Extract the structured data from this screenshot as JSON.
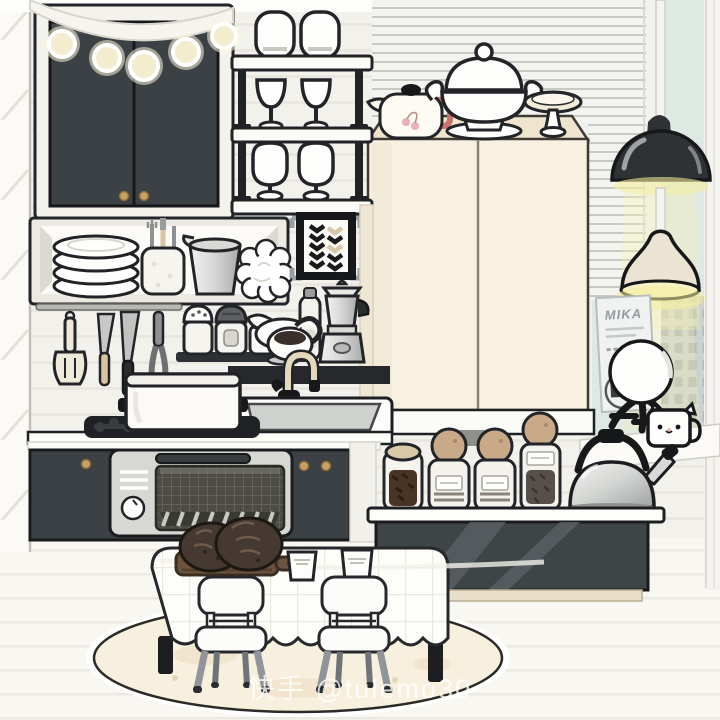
{
  "scene": {
    "name": "toca-style-kitchen-scene",
    "watermark": "快手 @tulemo30",
    "poster": {
      "title": "MIKA"
    }
  },
  "palette": {
    "cabinet_charcoal": "#3c4145",
    "outline_black": "#1c1e22",
    "fridge_cream": "#f8f1e1",
    "counter_white": "#fdfdfa",
    "knob_gold": "#c9a163",
    "lamp_glow_yellow": "#f5ef9e",
    "window_glass": "#dfe9e4",
    "bread_brown": "#463931",
    "board_brown": "#6b5340",
    "rug_cream": "#f7f0de",
    "jar_lid_tan": "#c8a988",
    "metal_silver": "#c6c8c6"
  },
  "inventory": [
    "string-lights",
    "upper-cabinet",
    "wine-glass-rack",
    "stemless-glasses",
    "wine-glasses",
    "goblets",
    "plate-stack",
    "utensil-crock",
    "metal-pitcher",
    "ruffle-decor",
    "chevron-art-frame",
    "spatula",
    "paring-knife",
    "chef-knife",
    "carving-fork",
    "salt-shaker",
    "pepper-shaker",
    "sugar-jar",
    "gravy-boat",
    "oil-bottle",
    "white-cup",
    "moka-pot",
    "faucet",
    "sink",
    "stockpot",
    "cooktop",
    "oven",
    "lower-cabinet",
    "refrigerator",
    "teapot-cherry",
    "soup-tureen",
    "cake-stand",
    "venetian-blinds",
    "window",
    "city-building",
    "black-dome-lamp",
    "cream-pendant-lamp",
    "mika-poster",
    "moon-lamp",
    "cat-face-mug",
    "storage-jars",
    "stove-kettle",
    "kitchen-island",
    "dining-table",
    "cutting-board",
    "bread-loaves",
    "paper-cups",
    "dining-chairs",
    "round-rug"
  ]
}
